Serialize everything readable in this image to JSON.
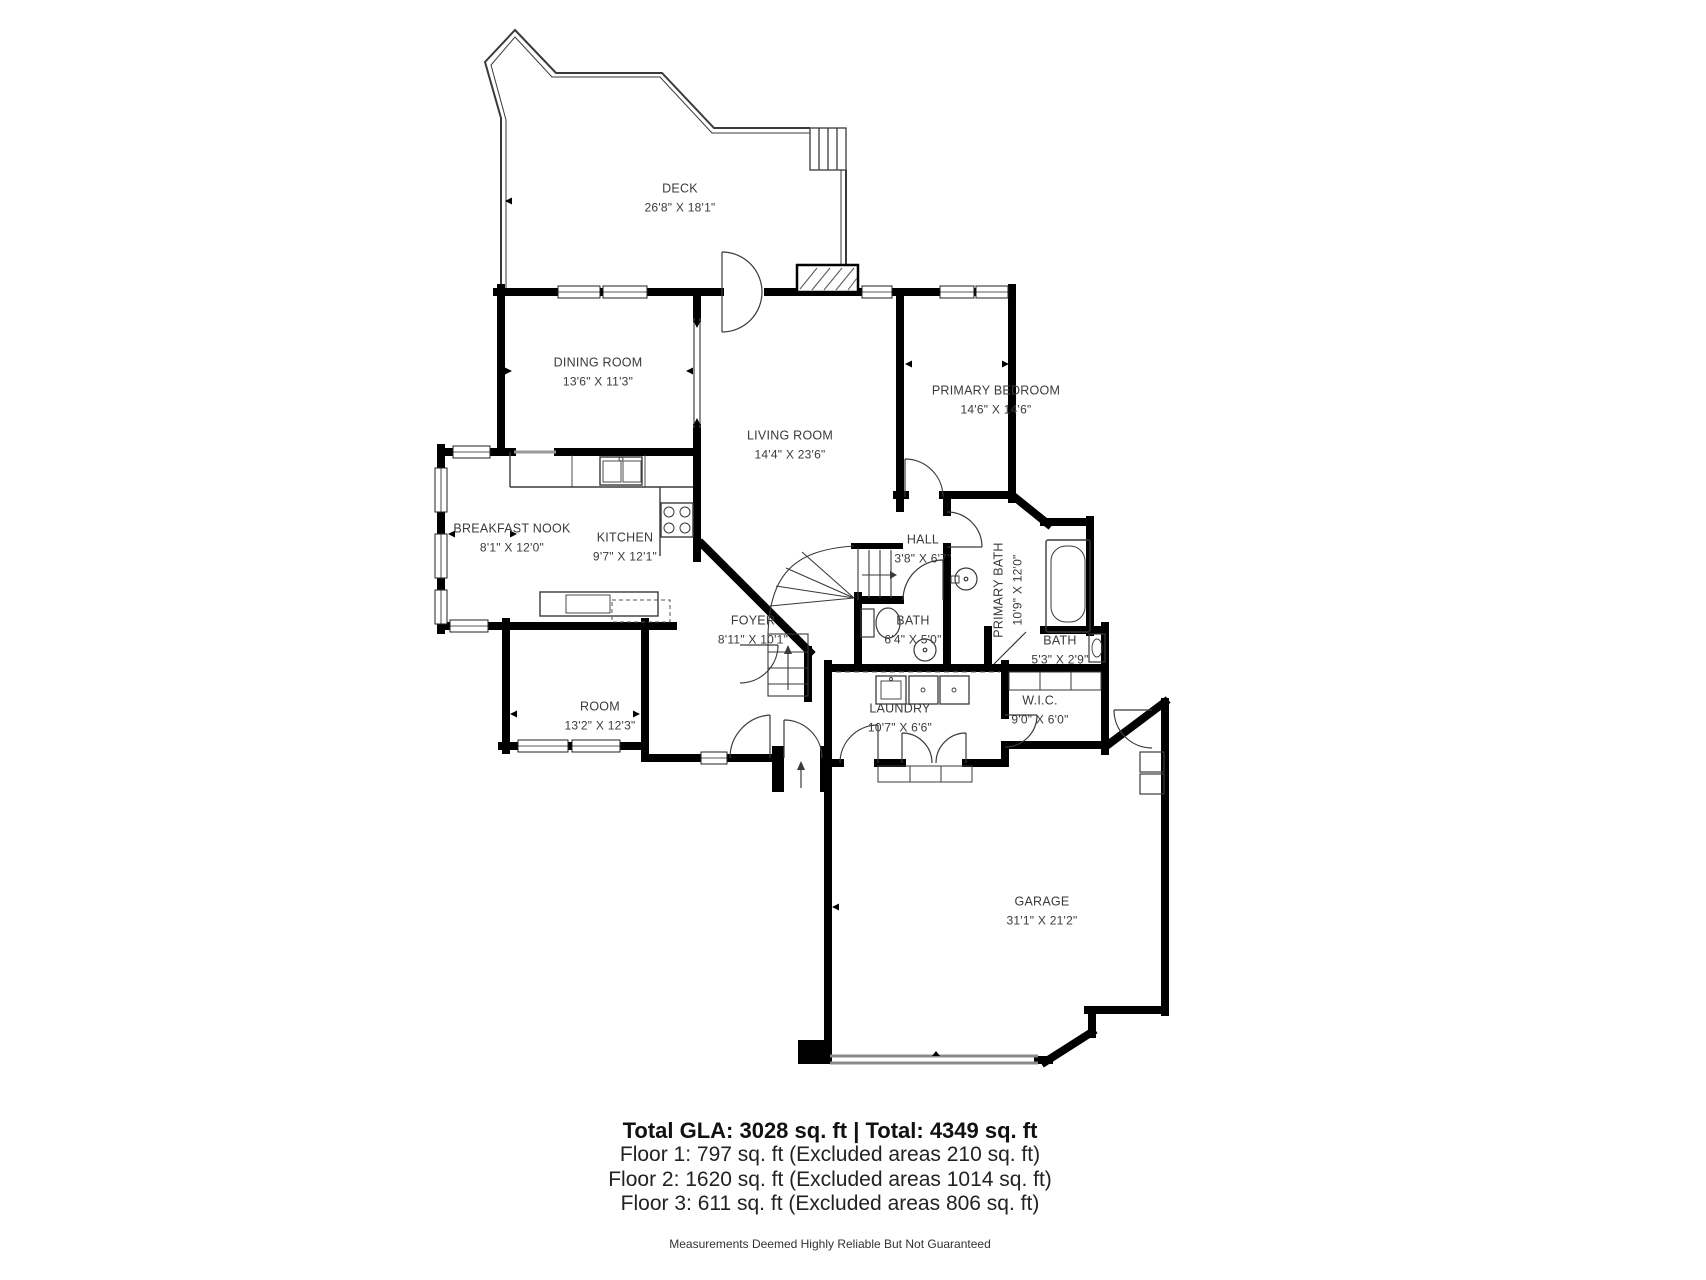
{
  "rooms": [
    {
      "id": "deck",
      "name": "DECK",
      "dims": "26'8\" X 18'1\""
    },
    {
      "id": "dining",
      "name": "DINING ROOM",
      "dims": "13'6\" X 11'3\""
    },
    {
      "id": "living",
      "name": "LIVING ROOM",
      "dims": "14'4\" X 23'6\""
    },
    {
      "id": "primary-bedroom",
      "name": "PRIMARY BEDROOM",
      "dims": "14'6\" X 14'6\""
    },
    {
      "id": "breakfast-nook",
      "name": "BREAKFAST NOOK",
      "dims": "8'1\" X 12'0\""
    },
    {
      "id": "kitchen",
      "name": "KITCHEN",
      "dims": "9'7\" X 12'1\""
    },
    {
      "id": "hall",
      "name": "HALL",
      "dims": "3'8\" X 6'7\""
    },
    {
      "id": "primary-bath",
      "name": "PRIMARY BATH",
      "dims": "10'9\" X 12'0\""
    },
    {
      "id": "bath",
      "name": "BATH",
      "dims": "6'4\" X 5'0\""
    },
    {
      "id": "bath-2",
      "name": "BATH",
      "dims": "5'3\" X 2'9\""
    },
    {
      "id": "foyer",
      "name": "FOYER",
      "dims": "8'11\" X 10'1\""
    },
    {
      "id": "laundry",
      "name": "LAUNDRY",
      "dims": "10'7\" X 6'6\""
    },
    {
      "id": "wic",
      "name": "W.I.C.",
      "dims": "9'0\" X 6'0\""
    },
    {
      "id": "room",
      "name": "ROOM",
      "dims": "13'2\" X 12'3\""
    },
    {
      "id": "garage",
      "name": "GARAGE",
      "dims": "31'1\" X 21'2\""
    }
  ],
  "summary": {
    "total": "Total GLA: 3028 sq. ft | Total: 4349 sq. ft",
    "floors": [
      "Floor 1: 797 sq. ft (Excluded areas 210 sq. ft)",
      "Floor 2: 1620 sq. ft (Excluded areas 1014 sq. ft)",
      "Floor 3: 611 sq. ft (Excluded areas 806 sq. ft)"
    ],
    "disclaimer": "Measurements Deemed Highly Reliable But Not Guaranteed"
  },
  "colors": {
    "wall": "#000000",
    "thin_line": "#3a3a3a",
    "text": "#3a3a3a",
    "garage_door": "#8a8a8a"
  }
}
